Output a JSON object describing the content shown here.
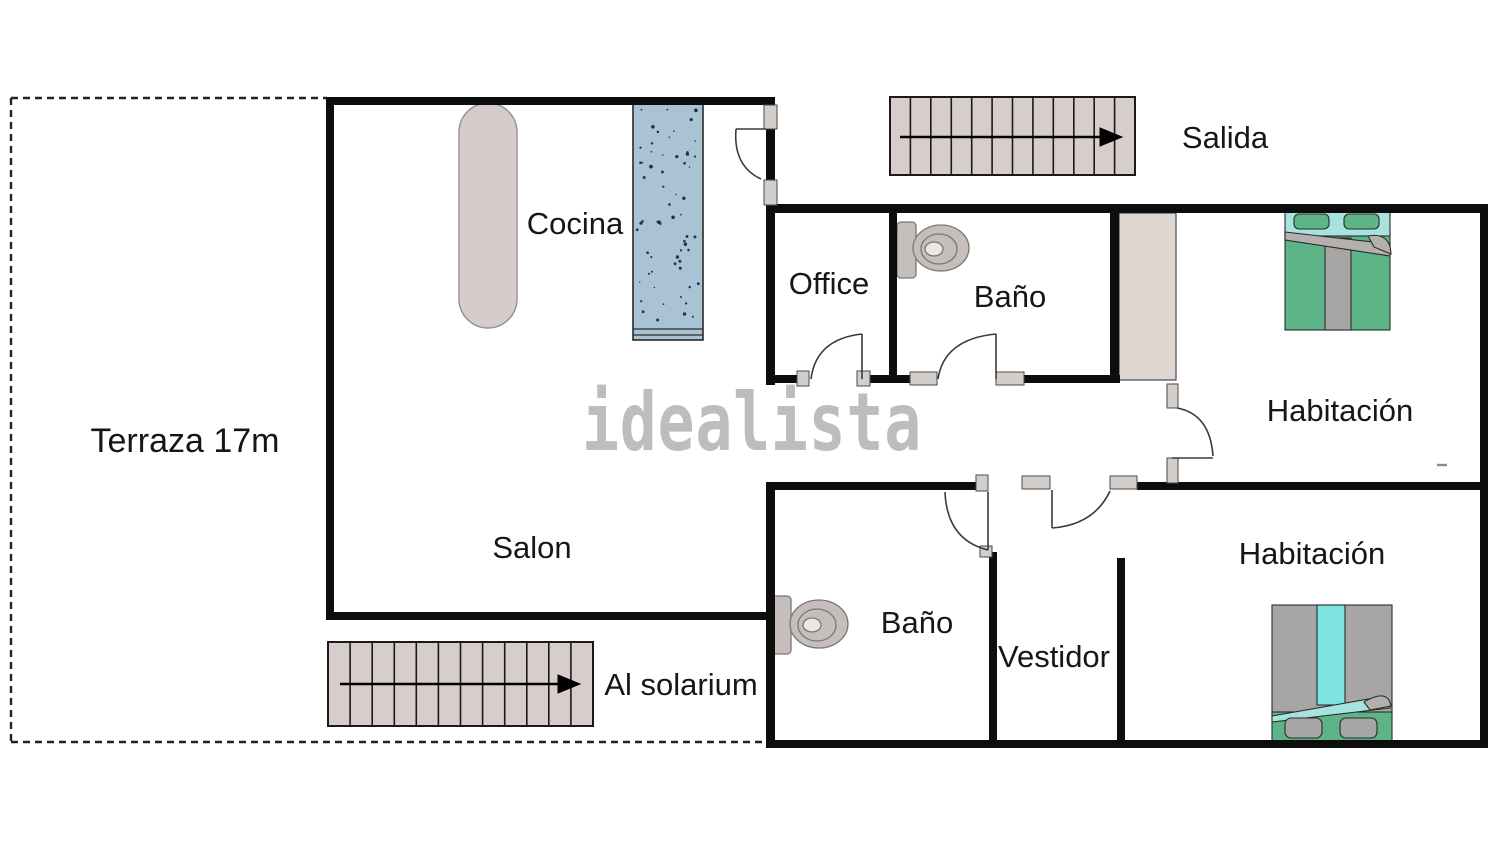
{
  "plan": {
    "watermark": "idealista",
    "labels": {
      "terraza": "Terraza 17m",
      "cocina": "Cocina",
      "salon": "Salon",
      "office": "Office",
      "bano_top": "Baño",
      "bano_bottom": "Baño",
      "vestidor": "Vestidor",
      "habitacion_top": "Habitación",
      "habitacion_bottom": "Habitación",
      "salida": "Salida",
      "al_solarium": "Al solarium"
    }
  },
  "colors": {
    "wall": "#0d0d0d",
    "door_frame": "#d3cec9",
    "door_arc": "#3a3a3a",
    "stairs": "#d7cecb",
    "kitchen_counter": "#d6cccb",
    "kitchen_island": "#a9c3d5",
    "island_speckle": "#1d3350",
    "wardrobe": "#ddd6d1",
    "toilet": "#c6beba",
    "toilet_inner": "#ebe7e4",
    "bed_green": "#5cb487",
    "bed_teal": "#a6e2de",
    "bed_cyan": "#7de4e0",
    "bed_gray": "#a8a6a4",
    "fold_gray": "#b3b0ad",
    "watermark": "#b6b6b6",
    "label_text": "#161616",
    "dashed_line": "#222222"
  }
}
